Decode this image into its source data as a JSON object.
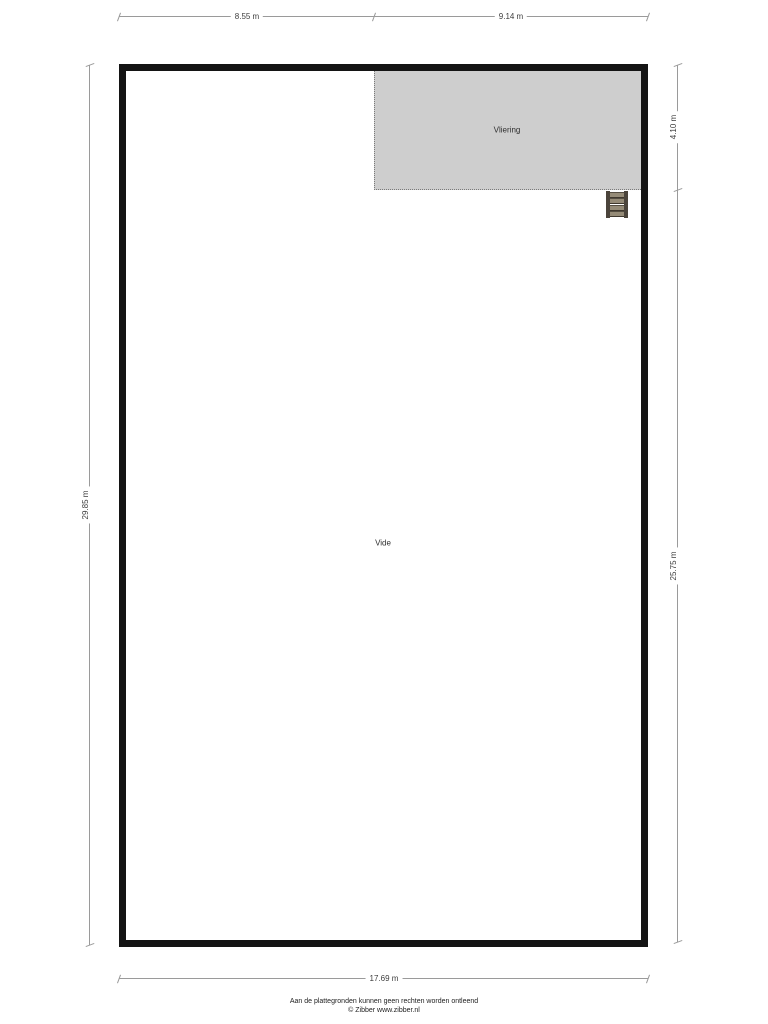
{
  "floorplan": {
    "rooms": {
      "vliering": {
        "label": "Vliering",
        "fill": "#cecece"
      },
      "vide": {
        "label": "Vide",
        "fill": "#ffffff"
      }
    },
    "dimensions": {
      "top_left": {
        "label": "8.55 m"
      },
      "top_right": {
        "label": "9.14 m"
      },
      "left": {
        "label": "29.85 m"
      },
      "right_top": {
        "label": "4.10 m"
      },
      "right_bottom": {
        "label": "25.75 m"
      },
      "bottom": {
        "label": "17.69 m"
      }
    },
    "icons": {
      "ladder": "ladder-icon"
    },
    "colors": {
      "wall": "#141414",
      "dimension_line": "#9a9a9a",
      "dimension_text": "#3d3d3d"
    }
  },
  "footer": {
    "disclaimer": "Aan de plattegronden kunnen geen rechten worden ontleend",
    "copyright": "© Zibber www.zibber.nl"
  }
}
